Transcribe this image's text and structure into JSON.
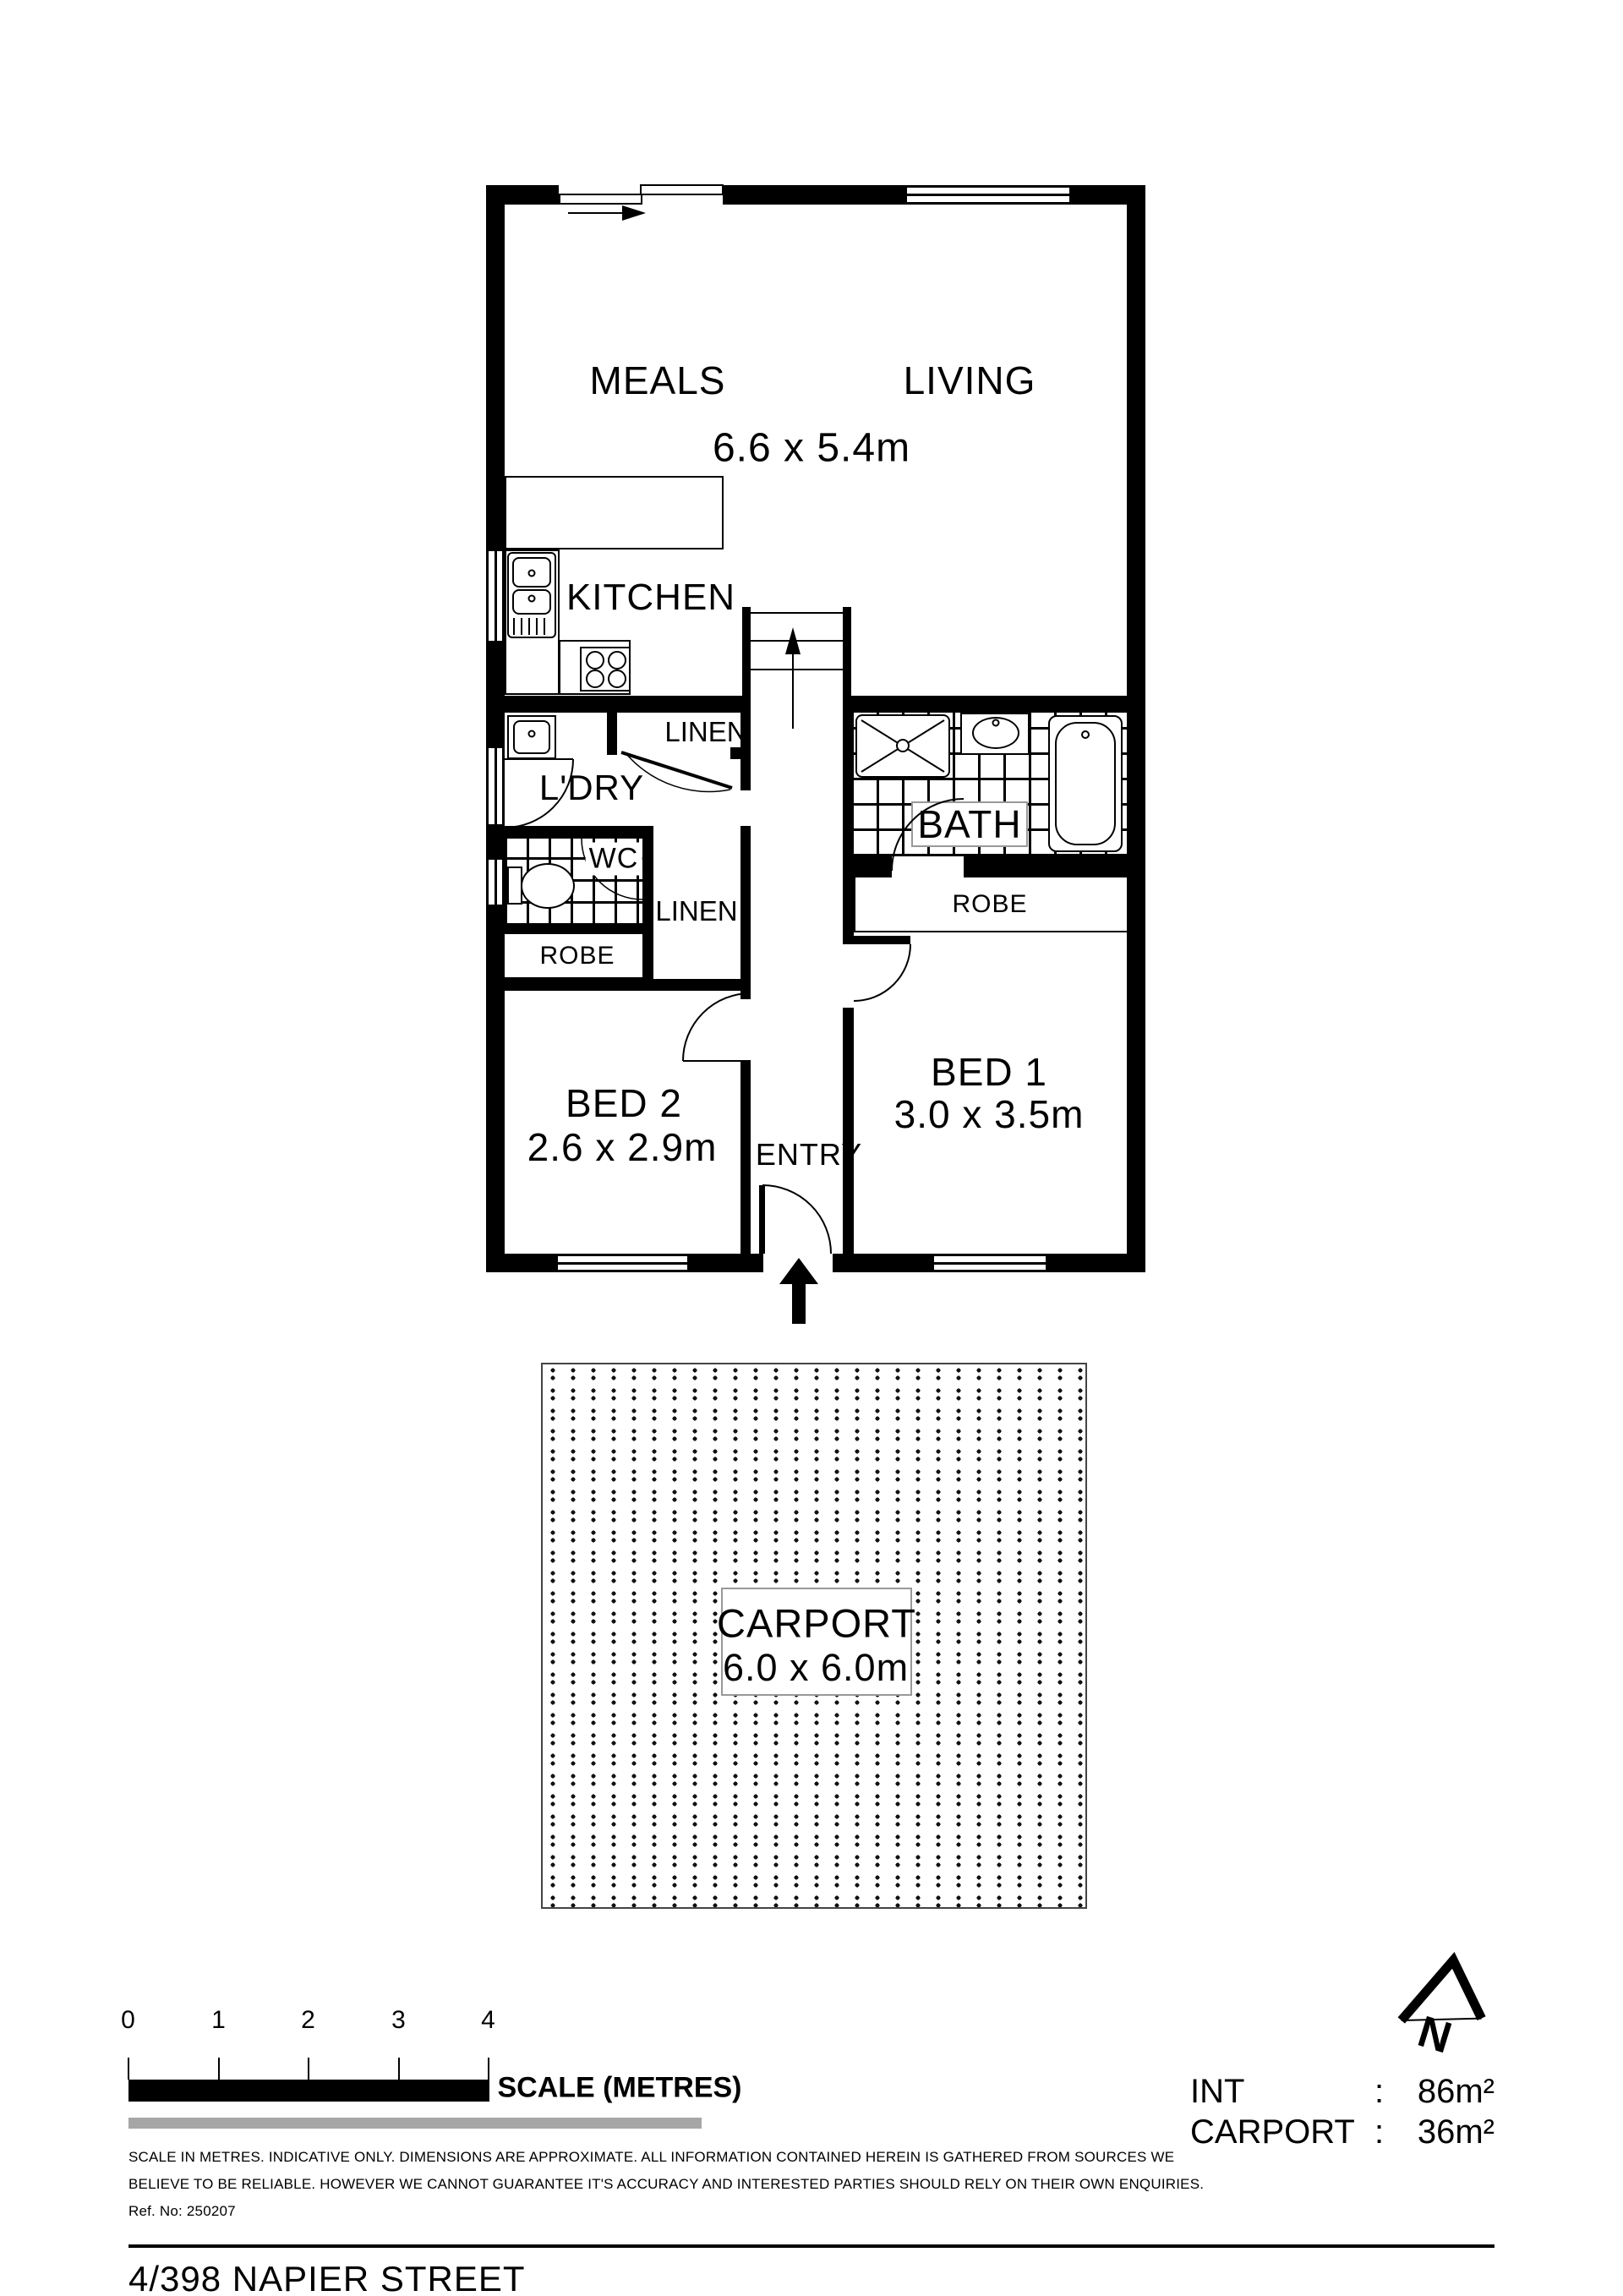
{
  "plan": {
    "rooms": {
      "meals": "MEALS",
      "living": "LIVING",
      "living_dims": "6.6 x 5.4m",
      "kitchen": "KITCHEN",
      "laundry": "L'DRY",
      "wc": "WC",
      "bath": "BATH",
      "linen_upper": "LINEN",
      "linen_lower": "LINEN",
      "robe_bed2": "ROBE",
      "robe_bed1": "ROBE",
      "bed2": "BED 2",
      "bed2_dims": "2.6 x 2.9m",
      "bed1": "BED 1",
      "bed1_dims": "3.0 x 3.5m",
      "entry": "ENTRY"
    },
    "carport": {
      "label": "CARPORT",
      "dims": "6.0 x 6.0m"
    }
  },
  "scalebar": {
    "ticks": [
      "0",
      "1",
      "2",
      "3",
      "4"
    ],
    "label": "SCALE (METRES)"
  },
  "disclaimer": {
    "line1": "SCALE IN METRES. INDICATIVE ONLY. DIMENSIONS ARE APPROXIMATE. ALL INFORMATION CONTAINED HEREIN IS GATHERED FROM SOURCES WE",
    "line2": "BELIEVE TO BE RELIABLE. HOWEVER WE CANNOT GUARANTEE IT'S ACCURACY AND INTERESTED PARTIES SHOULD RELY ON THEIR OWN ENQUIRIES.",
    "ref": "Ref. No: 250207"
  },
  "areas": {
    "int_label": "INT",
    "int_sep": ":",
    "int_value": "86m²",
    "carport_label": "CARPORT",
    "carport_sep": ":",
    "carport_value": "36m²"
  },
  "north_label": "N",
  "title": "4/398 NAPIER STREET",
  "colors": {
    "wall": "#000000",
    "gray_bar": "#a6a6a6"
  }
}
